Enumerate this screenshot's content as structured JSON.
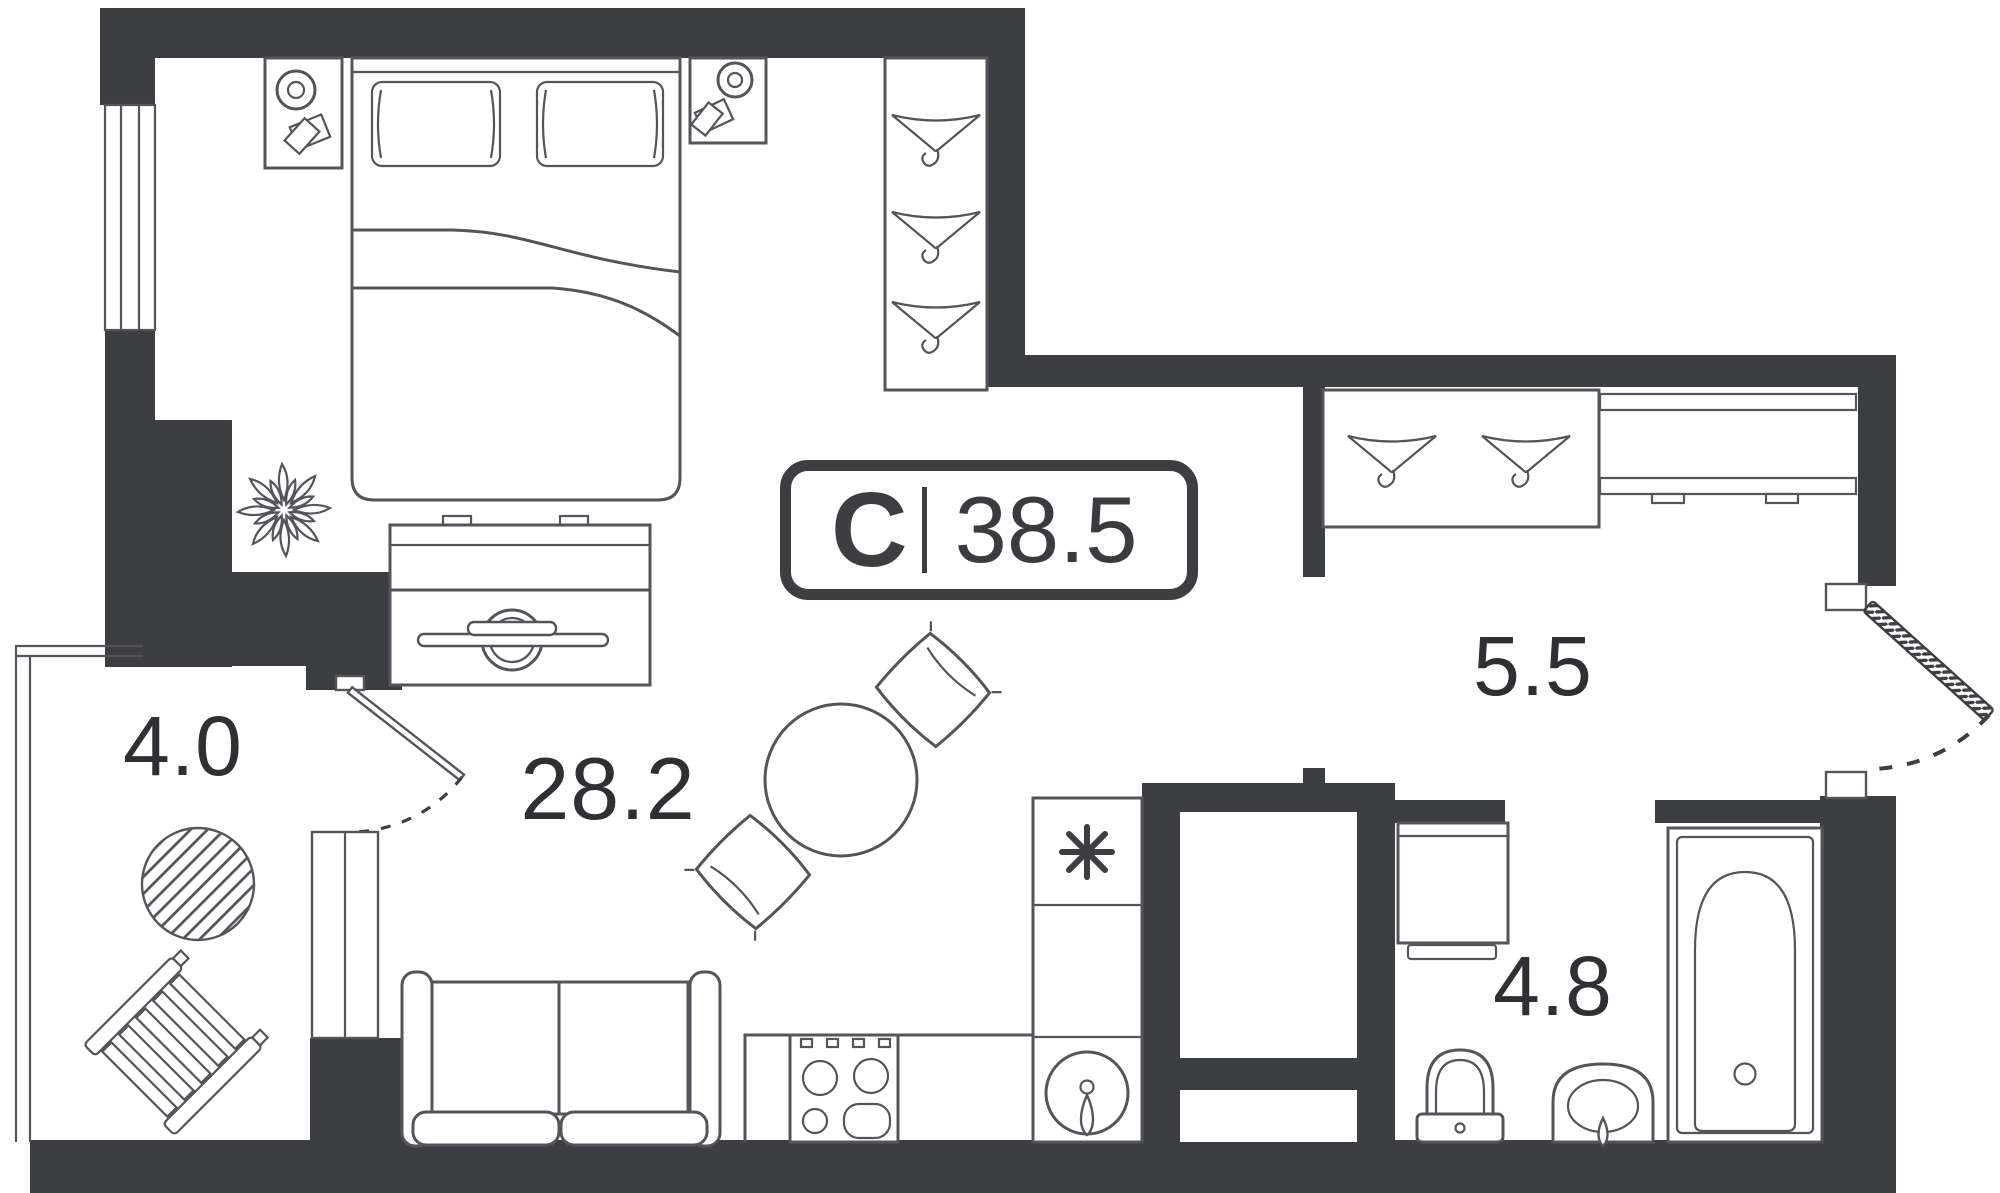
{
  "plan": {
    "unit_badge": {
      "type_label": "С",
      "area_label": "38.5"
    },
    "rooms": [
      {
        "id": "living",
        "area_label": "28.2"
      },
      {
        "id": "hallway",
        "area_label": "5.5"
      },
      {
        "id": "bathroom",
        "area_label": "4.8"
      },
      {
        "id": "balcony",
        "area_label": "4.0"
      }
    ],
    "icons": {
      "hanger-icon": "clothes-hanger triangle with hook",
      "snowflake-icon": "✳",
      "lamp-icon": "double circle",
      "plant-icon": "flower starburst",
      "faucet-icon": "teardrop tap"
    },
    "colors": {
      "wall": "#3d3e42",
      "line": "#54555a",
      "text": "#2f3033",
      "bg": "#ffffff"
    }
  }
}
